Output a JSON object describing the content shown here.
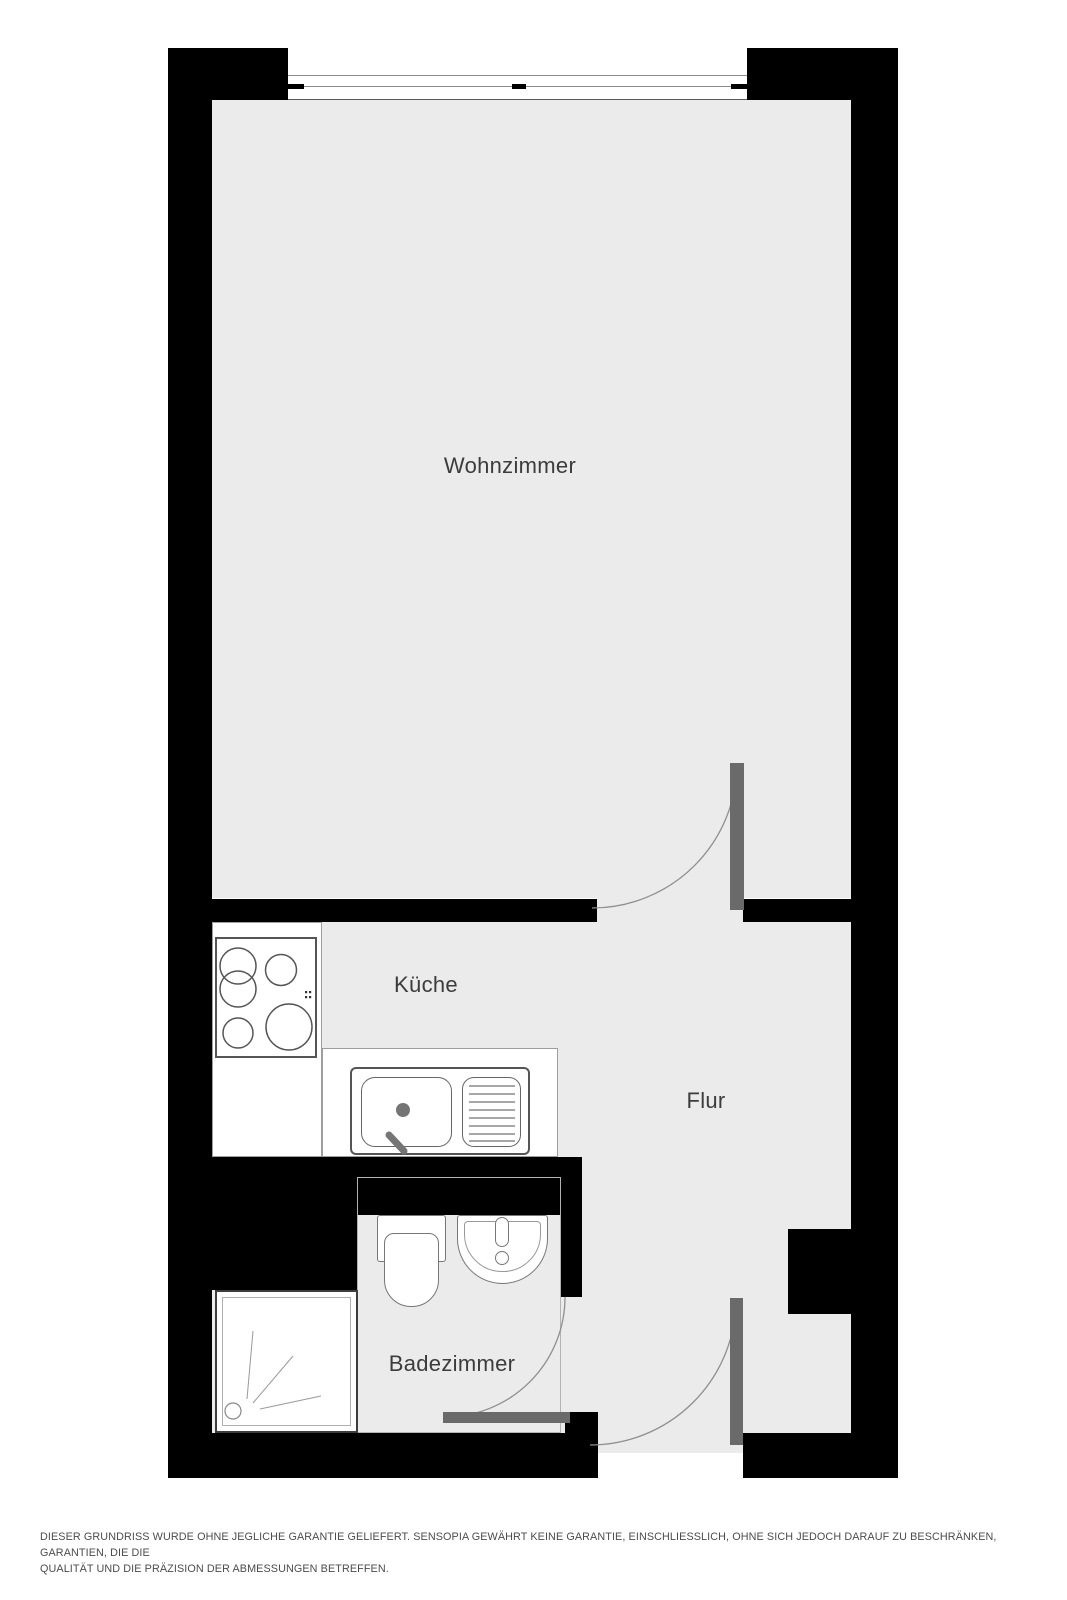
{
  "floorplan": {
    "rooms": [
      {
        "name": "wohnzimmer",
        "label": "Wohnzimmer"
      },
      {
        "name": "kueche",
        "label": "Küche"
      },
      {
        "name": "flur",
        "label": "Flur"
      },
      {
        "name": "badezimmer",
        "label": "Badezimmer"
      }
    ],
    "fixtures": [
      "window",
      "stove",
      "kitchen-sink",
      "shower",
      "toilet",
      "bathroom-sink"
    ],
    "doors": [
      "wohnzimmer-door",
      "badezimmer-door",
      "entry-door"
    ],
    "colors": {
      "wall": "#000000",
      "floor": "#ebebeb",
      "door_leaf": "#6a6a6a",
      "door_arc": "#8f8f8f",
      "fixture_outline": "#777777",
      "label_text": "#3c3c3c",
      "page_background": "#ffffff"
    }
  },
  "disclaimer": {
    "line1": "DIESER GRUNDRISS WURDE OHNE JEGLICHE GARANTIE GELIEFERT. SENSOPIA GEWÄHRT KEINE GARANTIE, EINSCHLIESSLICH, OHNE SICH JEDOCH DARAUF ZU BESCHRÄNKEN, GARANTIEN, DIE DIE",
    "line2": "QUALITÄT UND DIE PRÄZISION DER ABMESSUNGEN BETREFFEN."
  }
}
